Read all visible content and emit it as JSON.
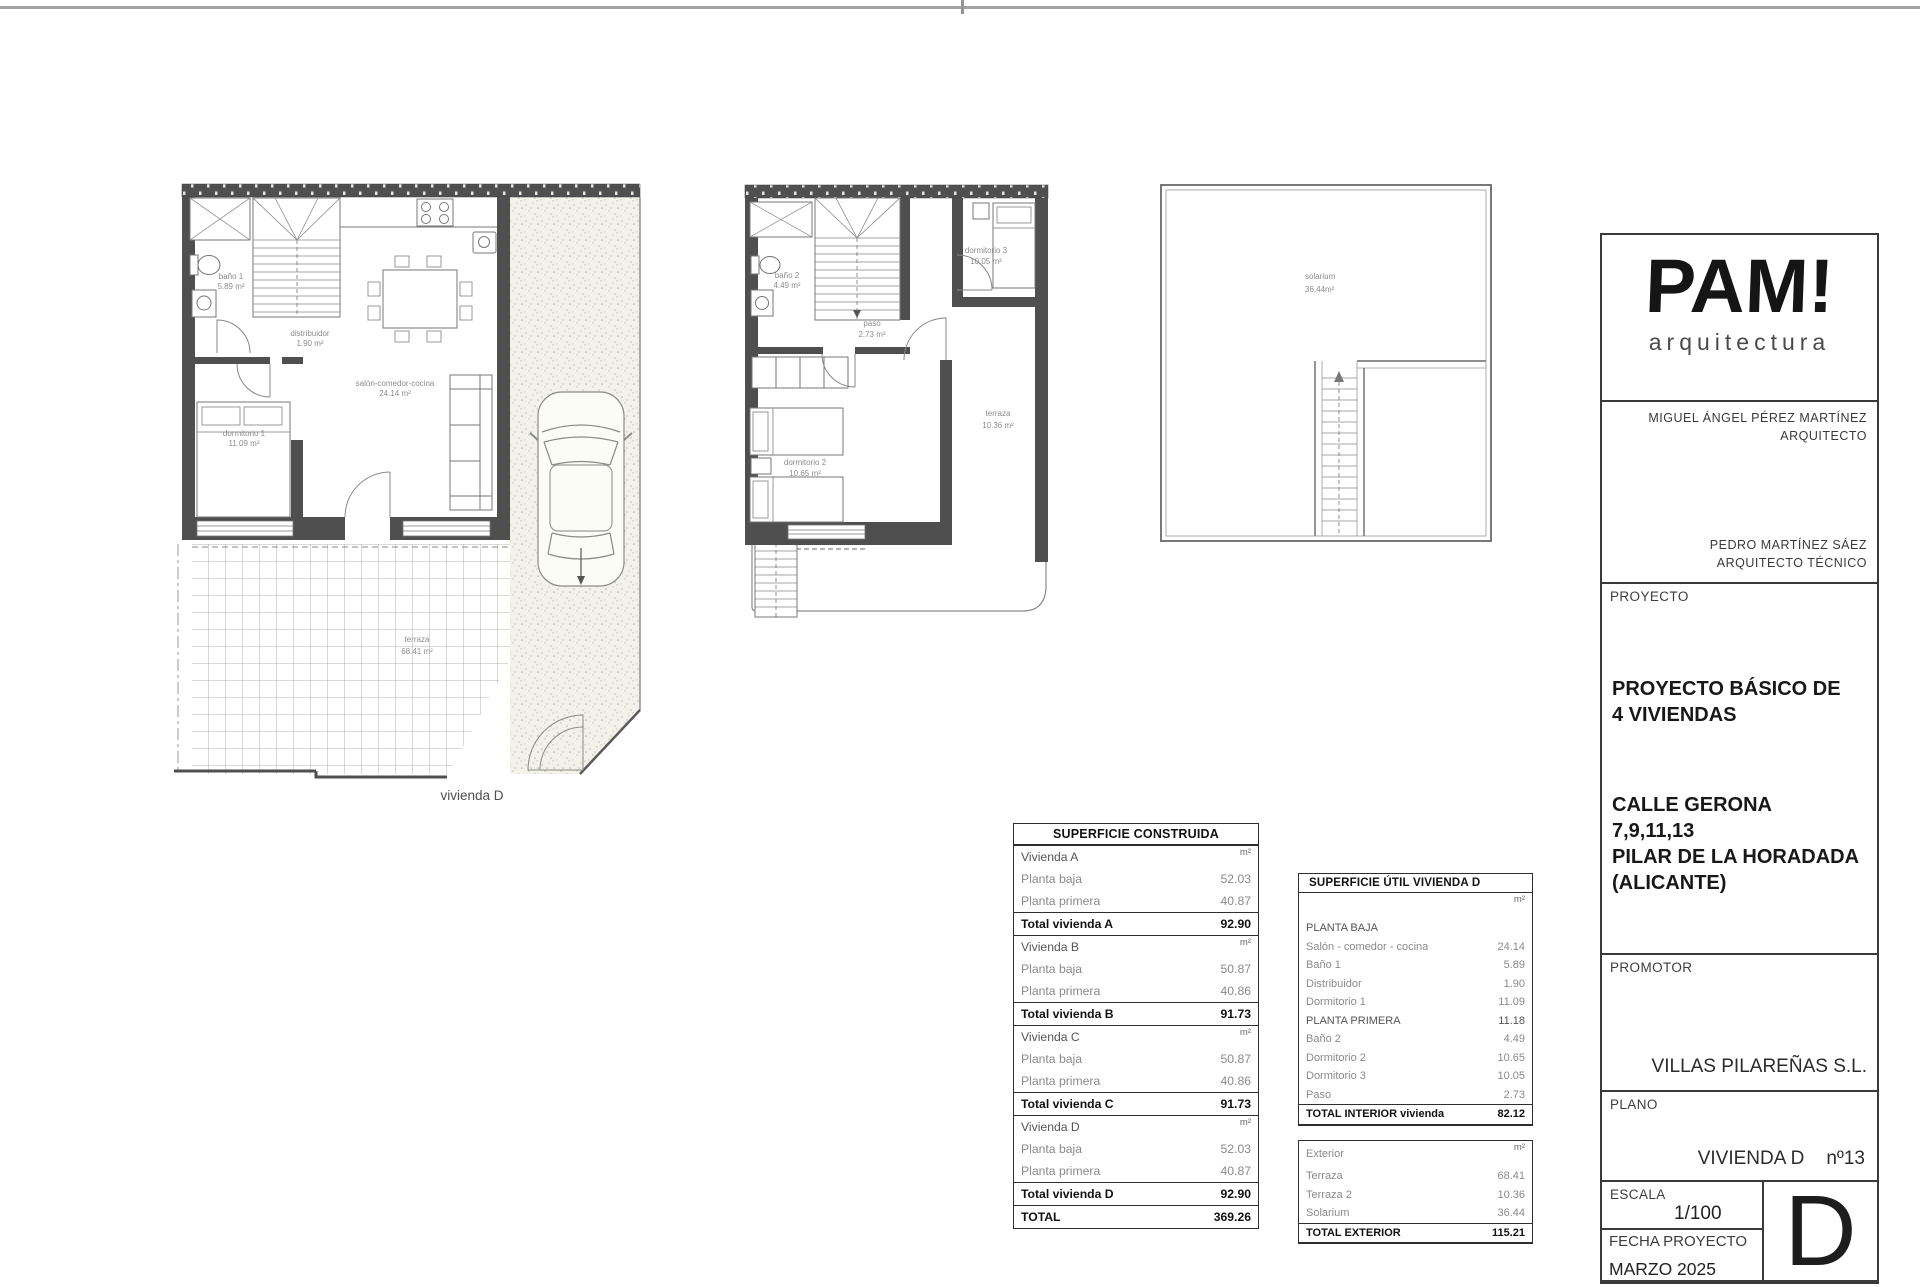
{
  "plans": {
    "ground": {
      "label": "vivienda D",
      "bano1_n": "baño 1",
      "bano1_a": "5.89 m²",
      "dist_n": "distribuidor",
      "dist_a": "1.90 m²",
      "salon_n": "salón-comedor-cocina",
      "salon_a": "24.14 m²",
      "dorm1_n": "dormitorio 1",
      "dorm1_a": "11.09 m²",
      "terraza_n": "terraza",
      "terraza_a": "68.41 m²"
    },
    "first": {
      "bano2_n": "baño 2",
      "bano2_a": "4.49 m²",
      "dorm3_n": "dormitorio 3",
      "dorm3_a": "10.05 m²",
      "paso_n": "paso",
      "paso_a": "2.73 m²",
      "dorm2_n": "dormitorio 2",
      "dorm2_a": "10.65 m²",
      "terraza_n": "terraza",
      "terraza_a": "10.36 m²"
    },
    "solarium": {
      "name_n": "solarium",
      "name_a": "36,44m²"
    }
  },
  "construida_table": {
    "title": "SUPERFICIE CONSTRUIDA",
    "rows": [
      {
        "label": "Vivienda A",
        "value": "m²",
        "style": "head"
      },
      {
        "label": "Planta baja",
        "value": "52.03",
        "style": "plain"
      },
      {
        "label": "Planta primera",
        "value": "40.87",
        "style": "plain"
      },
      {
        "label": "Total vivienda A",
        "value": "92.90",
        "style": "total"
      },
      {
        "label": "Vivienda B",
        "value": "m²",
        "style": "head"
      },
      {
        "label": "Planta baja",
        "value": "50.87",
        "style": "plain"
      },
      {
        "label": "Planta primera",
        "value": "40.86",
        "style": "plain"
      },
      {
        "label": "Total vivienda B",
        "value": "91.73",
        "style": "total"
      },
      {
        "label": "Vivienda C",
        "value": "m²",
        "style": "head"
      },
      {
        "label": "Planta baja",
        "value": "50.87",
        "style": "plain"
      },
      {
        "label": "Planta primera",
        "value": "40.86",
        "style": "plain"
      },
      {
        "label": "Total vivienda C",
        "value": "91.73",
        "style": "total"
      },
      {
        "label": "Vivienda D",
        "value": "m²",
        "style": "head"
      },
      {
        "label": "Planta baja",
        "value": "52.03",
        "style": "plain"
      },
      {
        "label": "Planta primera",
        "value": "40.87",
        "style": "plain"
      },
      {
        "label": "Total vivienda D",
        "value": "92.90",
        "style": "total"
      },
      {
        "label": "TOTAL",
        "value": "369.26",
        "style": "grand"
      }
    ]
  },
  "util_table": {
    "title": "SUPERFICIE ÚTIL VIVIENDA D",
    "interior_rows": [
      {
        "label": "",
        "value": "m²",
        "style": "unit"
      },
      {
        "label": "PLANTA BAJA",
        "value": "",
        "style": "section"
      },
      {
        "label": "Salón - comedor - cocina",
        "value": "24.14",
        "style": "plain"
      },
      {
        "label": "Baño 1",
        "value": "5.89",
        "style": "plain"
      },
      {
        "label": "Distribuidor",
        "value": "1.90",
        "style": "plain"
      },
      {
        "label": "Dormitorio 1",
        "value": "11.09",
        "style": "plain"
      },
      {
        "label": "PLANTA PRIMERA",
        "value": "11.18",
        "style": "section"
      },
      {
        "label": "Baño 2",
        "value": "4.49",
        "style": "plain"
      },
      {
        "label": "Dormitorio 2",
        "value": "10.65",
        "style": "plain"
      },
      {
        "label": "Dormitorio 3",
        "value": "10.05",
        "style": "plain"
      },
      {
        "label": "Paso",
        "value": "2.73",
        "style": "plain"
      },
      {
        "label": "TOTAL INTERIOR vivienda",
        "value": "82.12",
        "style": "total"
      }
    ],
    "exterior_rows": [
      {
        "label": "Exterior",
        "value": "m²",
        "style": "unit"
      },
      {
        "label": "Terraza",
        "value": "68.41",
        "style": "plain"
      },
      {
        "label": "Terraza 2",
        "value": "10.36",
        "style": "plain"
      },
      {
        "label": "Solarium",
        "value": "36.44",
        "style": "plain"
      },
      {
        "label": "TOTAL EXTERIOR",
        "value": "115.21",
        "style": "total"
      }
    ]
  },
  "titleblock": {
    "logo": "PAM!",
    "logo_sub": "arquitectura",
    "architect_line1": "MIGUEL ÁNGEL PÉREZ MARTÍNEZ",
    "architect_line2": "ARQUITECTO",
    "tech_line1": "PEDRO MARTÍNEZ SÁEZ",
    "tech_line2": "ARQUITECTO TÉCNICO",
    "proyecto_label": "PROYECTO",
    "proyecto_l1": "PROYECTO BÁSICO DE",
    "proyecto_l2": "4 VIVIENDAS",
    "addr_l1": "CALLE GERONA",
    "addr_l2": "7,9,11,13",
    "addr_l3": "PILAR DE LA HORADADA",
    "addr_l4": "(ALICANTE)",
    "promotor_label": "PROMOTOR",
    "promotor_name": "VILLAS PILAREÑAS S.L.",
    "plano_label": "PLANO",
    "plano_name": "VIVIENDA D",
    "plano_num": "nº13",
    "escala_label": "ESCALA",
    "escala_value": "1/100",
    "fecha_label": "FECHA PROYECTO",
    "fecha_value": "MARZO 2025",
    "sheet_letter": "D"
  },
  "colors": {
    "wall": "#4f4f4f",
    "line": "#777777",
    "accent": "#2e2e2e"
  }
}
